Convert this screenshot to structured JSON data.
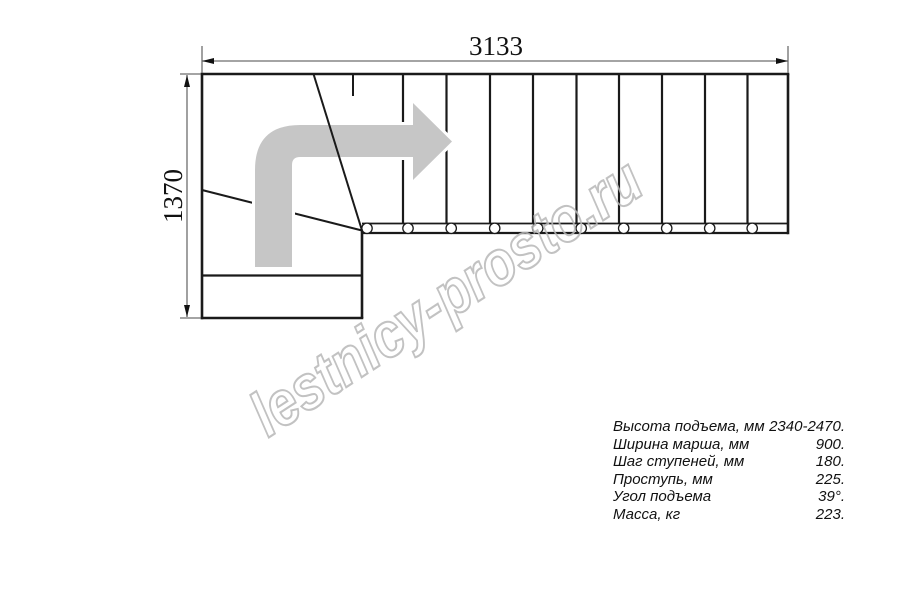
{
  "drawing": {
    "title": "staircase-plan",
    "width_dim_label": "3133",
    "height_dim_label": "1370",
    "watermark": "lestnicy-prosto.ru"
  },
  "specs": {
    "rows": [
      {
        "label": "Высота подъема, мм",
        "value": "2340-2470."
      },
      {
        "label": "Ширина марша, мм",
        "value": "900."
      },
      {
        "label": "Шаг ступеней, мм",
        "value": "180."
      },
      {
        "label": "Проступь, мм",
        "value": "225."
      },
      {
        "label": "Угол подъема",
        "value": "39°."
      },
      {
        "label": "Масса, кг",
        "value": "223."
      }
    ]
  },
  "colors": {
    "line": "#1a1a1a",
    "dim_line": "#6e6e6e",
    "arrow_fill": "#c6c6c6",
    "watermark_stroke": "#b8b8b8",
    "text": "#111111"
  }
}
